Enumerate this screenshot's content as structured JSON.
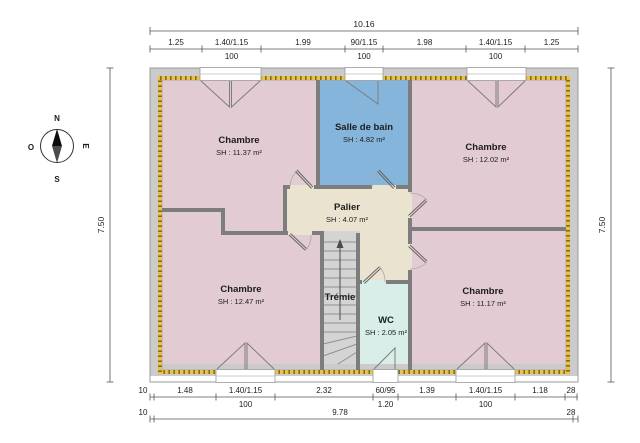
{
  "plan_title": "Floor plan - upper storey",
  "compass": {
    "north": "N",
    "south": "S",
    "east": "E",
    "west": "O"
  },
  "rooms": {
    "chambre_tl": {
      "name": "Chambre",
      "area": "SH : 11.37 m²"
    },
    "salle_de_bain": {
      "name": "Salle de bain",
      "area": "SH : 4.82 m²"
    },
    "chambre_tr": {
      "name": "Chambre",
      "area": "SH : 12.02 m²"
    },
    "palier": {
      "name": "Palier",
      "area": "SH : 4.07 m²"
    },
    "chambre_bl": {
      "name": "Chambre",
      "area": "SH : 12.47 m²"
    },
    "tremie": {
      "name": "Trémie"
    },
    "wc": {
      "name": "WC",
      "area": "SH : 2.05 m²"
    },
    "chambre_br": {
      "name": "Chambre",
      "area": "SH : 11.17 m²"
    }
  },
  "dimensions": {
    "top_total": "10.16",
    "top_segments": [
      "1.25",
      "1.40/1.15",
      "1.99",
      "90/1.15",
      "1.98",
      "1.40/1.15",
      "1.25"
    ],
    "top_subs": [
      "100",
      "100",
      "100"
    ],
    "bottom_segments": [
      "10",
      "1.48",
      "1.40/1.15",
      "2.32",
      "60/95",
      "1.39",
      "1.40/1.15",
      "1.18",
      "28"
    ],
    "bottom_subs": [
      "100",
      "1.20",
      "100"
    ],
    "bottom_total": [
      "10",
      "9.78",
      "28"
    ],
    "left_total": "7.50",
    "right_total": "7.50"
  },
  "colors": {
    "bedroom_fill": "#e3cbd3",
    "bathroom_fill": "#85b5da",
    "landing_fill": "#eae3d0",
    "wc_fill": "#daeee9",
    "stair_fill": "#d4d4d4",
    "exterior_wall": "#cbcbcb",
    "interior_wall": "#7d7d7d",
    "insulation_yellow": "#edbf45",
    "insulation_dash": "#77702f"
  }
}
